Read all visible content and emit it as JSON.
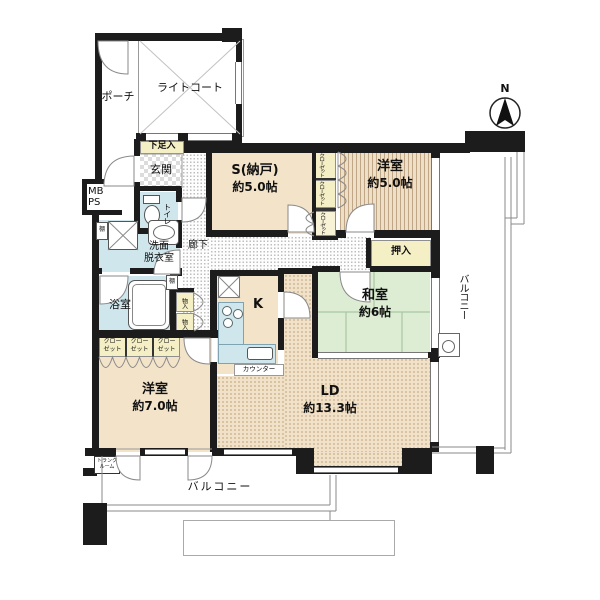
{
  "meta": {
    "type": "apartment-floor-plan"
  },
  "labels": {
    "porch": "ポーチ",
    "light_court": "ライトコート",
    "shoe_cabinet": "下足入",
    "entrance": "玄関",
    "meter_box": {
      "line1": "MB",
      "line2": "PS"
    },
    "toilet": "トイレ",
    "shelf_a": "棚",
    "shelf_b": "棚",
    "washroom": {
      "line1": "洗面",
      "line2": "脱衣室"
    },
    "bathroom": "浴室",
    "hallway": "廊下",
    "storage_room": {
      "line1": "S(納戸)",
      "line2": "約5.0帖"
    },
    "closets_vertical": [
      "クローゼット",
      "クローゼット",
      "クローゼット"
    ],
    "western_room_5": {
      "line1": "洋室",
      "line2": "約5.0帖"
    },
    "oshiire": "押入",
    "japanese_room": {
      "line1": "和室",
      "line2": "約6帖"
    },
    "kitchen": "K",
    "counter": "カウンター",
    "living_dining": {
      "line1": "LD",
      "line2": "約13.3帖"
    },
    "storage_small": [
      "物入",
      "物入"
    ],
    "closet_row": [
      {
        "line1": "クロー",
        "line2": "ゼット"
      },
      {
        "line1": "クロー",
        "line2": "ゼット"
      },
      {
        "line1": "クロー",
        "line2": "ゼット"
      }
    ],
    "western_room_7": {
      "line1": "洋室",
      "line2": "約7.0帖"
    },
    "trunk_room": {
      "line1": "トランク",
      "line2": "ルーム"
    },
    "balcony_bottom": "バルコニー",
    "balcony_right": "バルコニー",
    "compass_north": "N"
  },
  "colors": {
    "wall": "#1c1c1c",
    "flooring_beige": "#f2e3c9",
    "ld_pattern_beige": "#f0e1c8",
    "tatami_green": "#dcedd4",
    "water_area_blue": "#cfe6ec",
    "closet_yellow": "#f5efc5",
    "line_gray": "#8a8a8a"
  }
}
